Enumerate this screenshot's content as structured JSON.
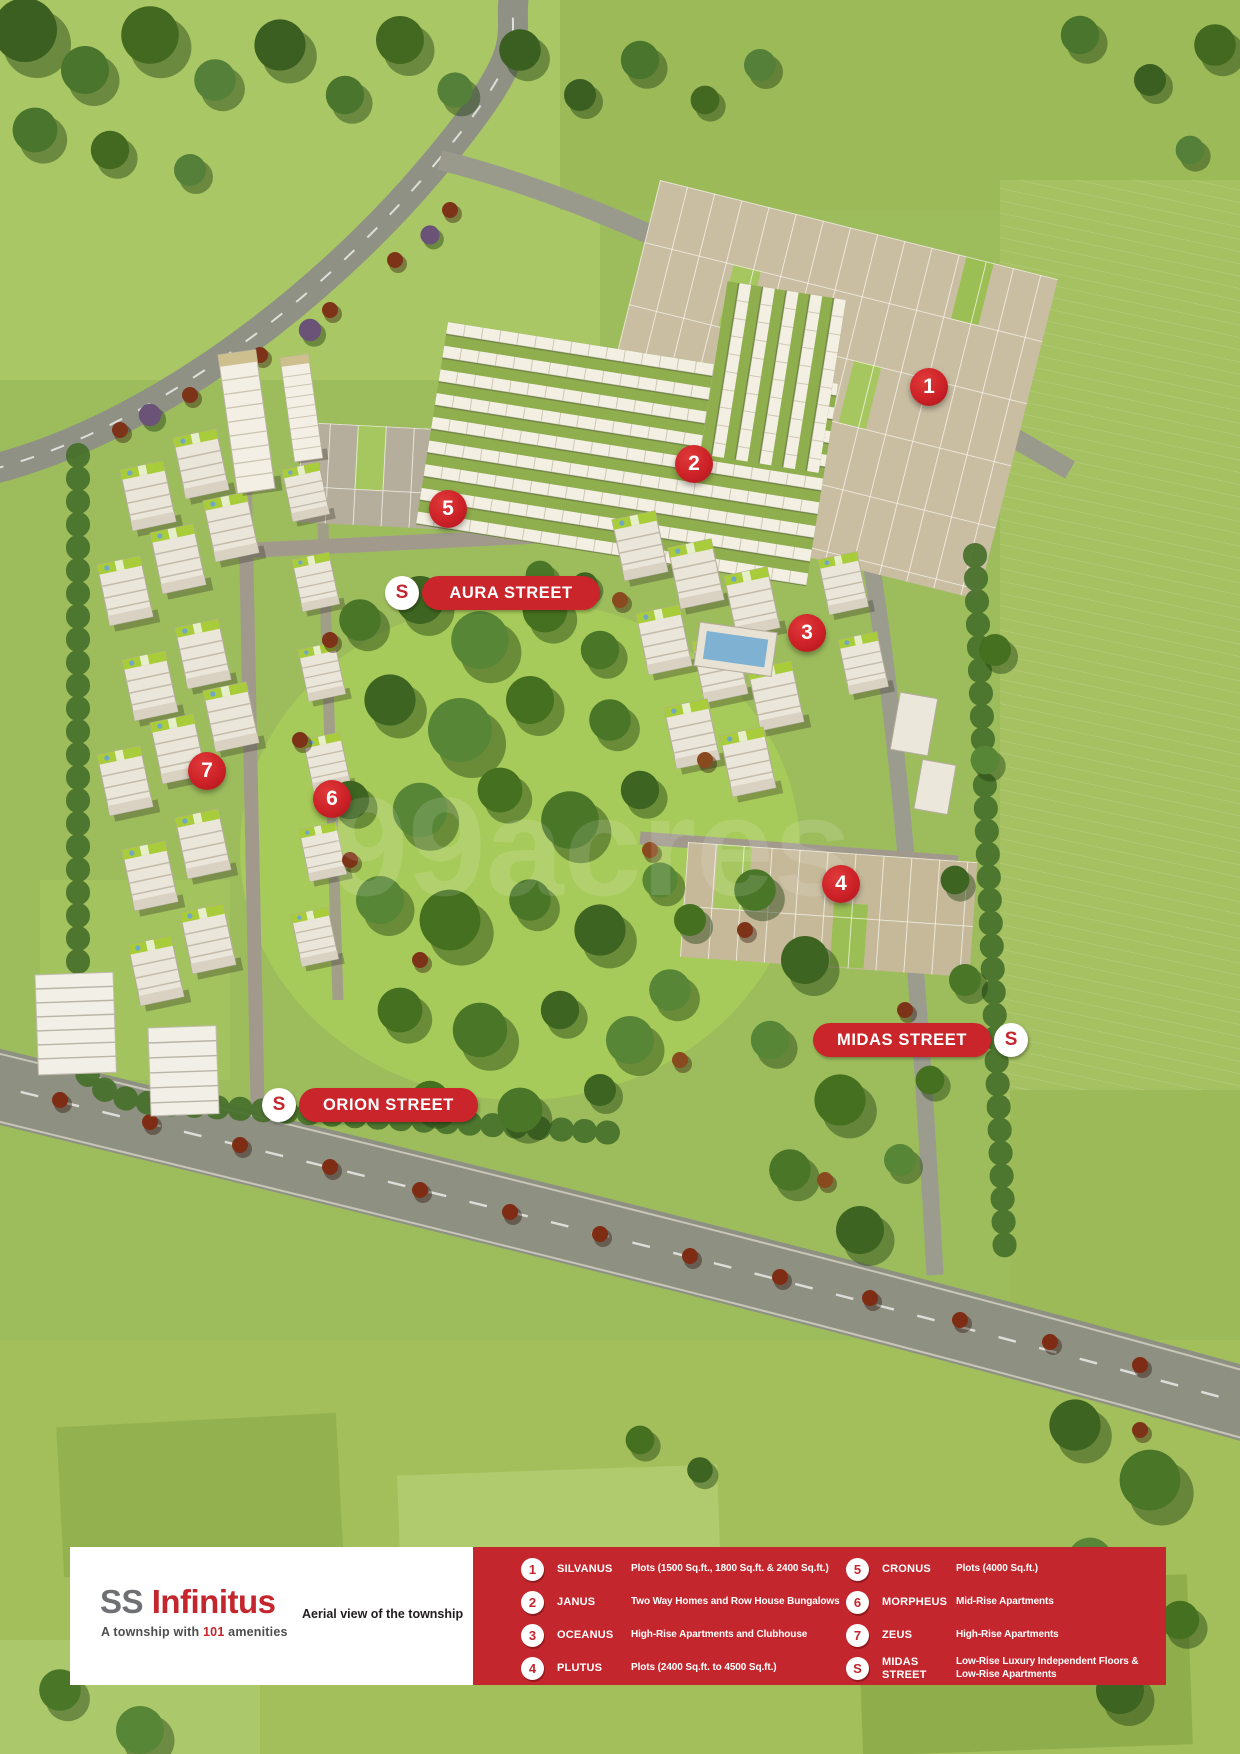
{
  "map": {
    "watermark": "99acres",
    "markers": [
      {
        "number": "1"
      },
      {
        "number": "2"
      },
      {
        "number": "3"
      },
      {
        "number": "4"
      },
      {
        "number": "5"
      },
      {
        "number": "6"
      },
      {
        "number": "7"
      }
    ],
    "street_labels": [
      {
        "badge": "S",
        "label": "AURA STREET"
      },
      {
        "badge": "S",
        "label": "ORION STREET"
      },
      {
        "badge": "S",
        "label": "MIDAS STREET"
      }
    ]
  },
  "footer": {
    "brand": {
      "name_gray": "SS",
      "name_red": " Infinitus",
      "tagline_pre": "A township with ",
      "tagline_num": "101",
      "tagline_post": " amenities"
    },
    "caption": "Aerial view of the township",
    "legend": {
      "items": [
        {
          "badge": "1",
          "name": "SILVANUS",
          "desc": "Plots (1500 Sq.ft., 1800 Sq.ft. & 2400 Sq.ft.)"
        },
        {
          "badge": "2",
          "name": "JANUS",
          "desc": "Two Way Homes and Row House Bungalows"
        },
        {
          "badge": "3",
          "name": "OCEANUS",
          "desc": "High-Rise Apartments and Clubhouse"
        },
        {
          "badge": "4",
          "name": "PLUTUS",
          "desc": "Plots (2400 Sq.ft. to 4500 Sq.ft.)"
        },
        {
          "badge": "5",
          "name": "CRONUS",
          "desc": "Plots (4000 Sq.ft.)"
        },
        {
          "badge": "6",
          "name": "MORPHEUS",
          "desc": "Mid-Rise Apartments"
        },
        {
          "badge": "7",
          "name": "ZEUS",
          "desc": "High-Rise Apartments"
        },
        {
          "badge": "S",
          "name": "MIDAS STREET",
          "desc": "Low-Rise Luxury Independent Floors & Low-Rise Apartments"
        }
      ]
    }
  },
  "colors": {
    "accent_red": "#c4262d",
    "marker_red": "#cc2127",
    "grass_green": "#9dbd5d",
    "badge_white": "#ffffff"
  }
}
